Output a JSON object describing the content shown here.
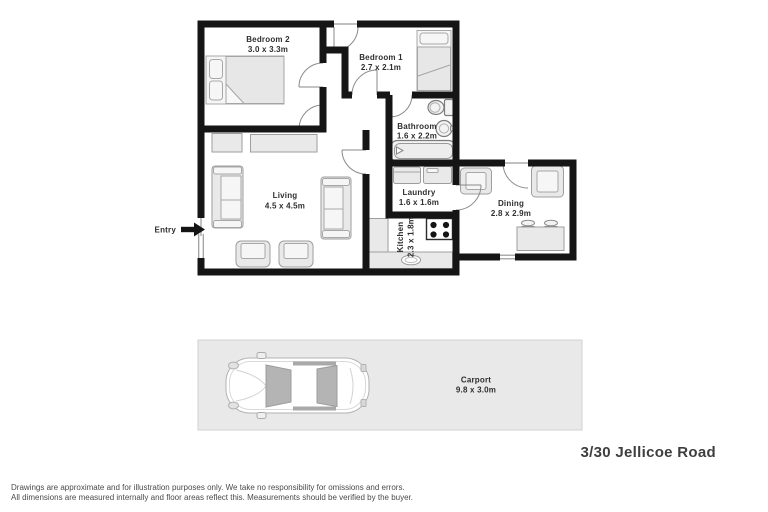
{
  "floorplan": {
    "rooms": [
      {
        "id": "bedroom2",
        "name": "Bedroom 2",
        "dims": "3.0 x 3.3m"
      },
      {
        "id": "bedroom1",
        "name": "Bedroom 1",
        "dims": "2.7 x 2.1m"
      },
      {
        "id": "bathroom",
        "name": "Bathroom",
        "dims": "1.6 x 2.2m"
      },
      {
        "id": "laundry",
        "name": "Laundry",
        "dims": "1.6 x 1.6m"
      },
      {
        "id": "living",
        "name": "Living",
        "dims": "4.5 x 4.5m"
      },
      {
        "id": "kitchen",
        "name": "Kitchen",
        "dims": "2.3 x 1.8m"
      },
      {
        "id": "dining",
        "name": "Dining",
        "dims": "2.8 x 2.9m"
      }
    ],
    "entry_label": "Entry",
    "carport": {
      "name": "Carport",
      "dims": "9.8 x 3.0m"
    }
  },
  "address": "3/30 Jellicoe Road",
  "disclaimer": {
    "line1": "Drawings are approximate and for illustration purposes only. We take no responsibility for omissions and errors.",
    "line2": "All dimensions are measured internally and floor areas reflect this. Measurements should be verified by the buyer."
  },
  "colors": {
    "wall": "#151515",
    "furniture_fill": "#e9e9e9",
    "furniture_stroke": "#9e9e9e",
    "carport_bg": "#e9e9e9",
    "label_text": "#2e2e2e"
  }
}
